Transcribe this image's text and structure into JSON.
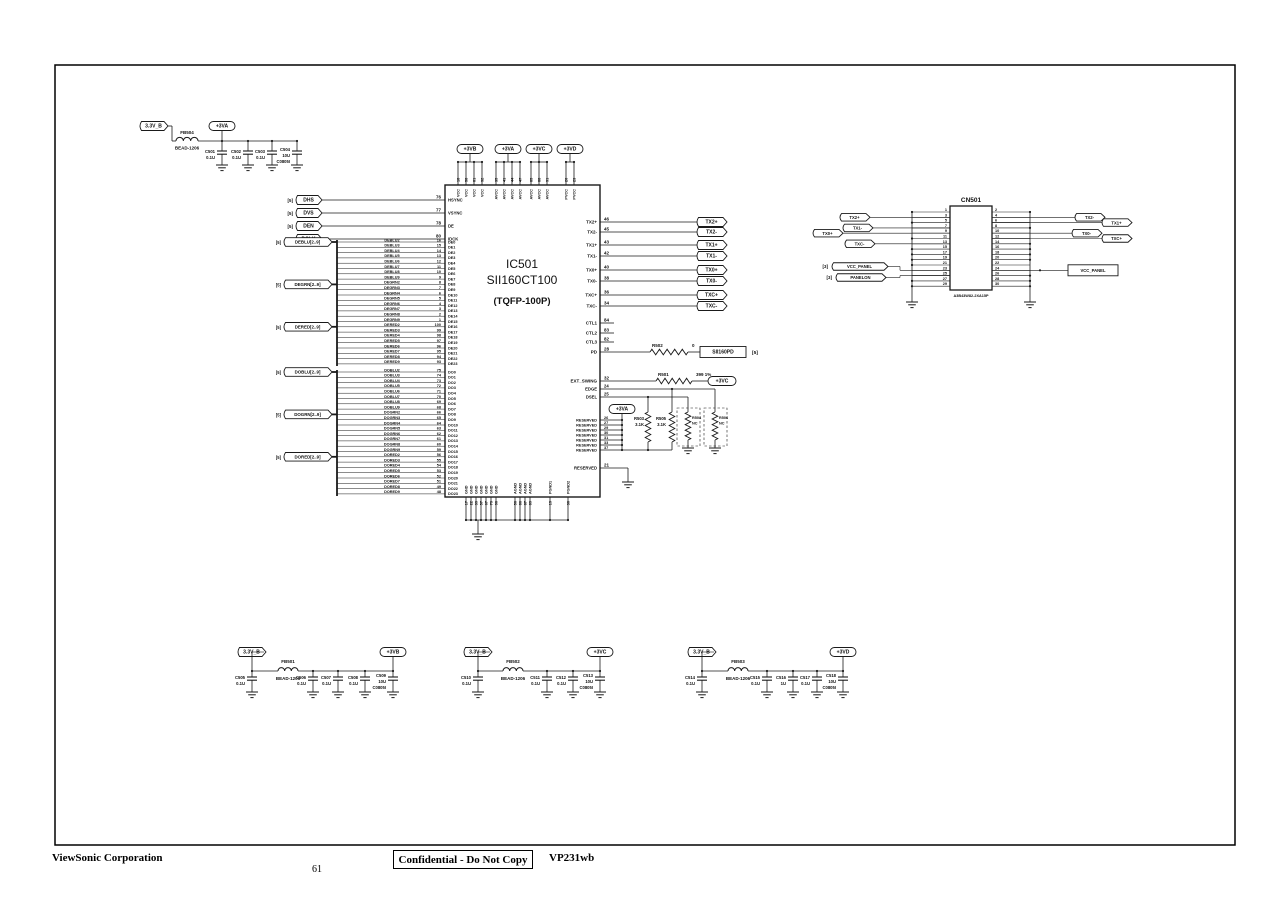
{
  "footer": {
    "company": "ViewSonic Corporation",
    "page_number": "61",
    "confidential": "Confidential - Do Not Copy",
    "model": "VP231wb"
  },
  "power_filters": [
    {
      "input": "3.3V_B",
      "bead": {
        "ref": "FB504",
        "part": "BEAD-1206"
      },
      "output": "+3VA",
      "caps": [
        [
          "C501",
          "0.1U"
        ],
        [
          "C502",
          "0.1U"
        ],
        [
          "C503",
          "0.1U"
        ],
        [
          "C504",
          "10U",
          "C0805I"
        ]
      ]
    },
    {
      "input": "3.3V_B",
      "bead": {
        "ref": "FB501",
        "part": "BEAD-1206"
      },
      "output": "+3VB",
      "pre_cap": [
        "C505",
        "0.1U"
      ],
      "caps": [
        [
          "C506",
          "0.1U"
        ],
        [
          "C507",
          "0.1U"
        ],
        [
          "C508",
          "0.1U"
        ],
        [
          "C509",
          "10U",
          "C0805I"
        ]
      ]
    },
    {
      "input": "3.3V_B",
      "bead": {
        "ref": "FB502",
        "part": "BEAD-1206"
      },
      "output": "+3VC",
      "pre_cap": [
        "C510",
        "0.1U"
      ],
      "caps": [
        [
          "C511",
          "0.1U"
        ],
        [
          "C512",
          "0.1U"
        ],
        [
          "C513",
          "10U",
          "C0805I"
        ]
      ]
    },
    {
      "input": "3.3V_B",
      "bead": {
        "ref": "FB503",
        "part": "BEAD-1206"
      },
      "output": "+3VD",
      "pre_cap": [
        "C514",
        "0.1U"
      ],
      "caps": [
        [
          "C515",
          "0.1U"
        ],
        [
          "C516",
          "1U"
        ],
        [
          "C517",
          "0.1U"
        ],
        [
          "C518",
          "10U",
          "C0805I"
        ]
      ]
    }
  ],
  "ic": {
    "ref": "IC501",
    "part": "SII160CT100",
    "package": "(TQFP-100P)",
    "control_inputs": [
      {
        "sheet": "[5]",
        "name": "DHS",
        "pin": "76",
        "signal": "HSYNC"
      },
      {
        "sheet": "[5]",
        "name": "DVS",
        "pin": "77",
        "signal": "VSYNC"
      },
      {
        "sheet": "[5]",
        "name": "DEN",
        "pin": "78",
        "signal": "DE"
      },
      {
        "sheet": "[5]",
        "name": "DCLK",
        "pin": "80",
        "signal": "IDCK"
      }
    ],
    "input_buses": [
      {
        "sheet": "[5]",
        "name": "DEBLU[2..9]"
      },
      {
        "sheet": "[5]",
        "name": "DEGRN[2..9]"
      },
      {
        "sheet": "[5]",
        "name": "DERED[2..9]"
      }
    ],
    "input_bits": [
      [
        "DEBLU2",
        "16",
        "DE0"
      ],
      [
        "DEBLU3",
        "15",
        "DE1"
      ],
      [
        "DEBLU4",
        "14",
        "DE2"
      ],
      [
        "DEBLU5",
        "13",
        "DE3"
      ],
      [
        "DEBLU6",
        "12",
        "DE4"
      ],
      [
        "DEBLU7",
        "11",
        "DE5"
      ],
      [
        "DEBLU8",
        "10",
        "DE6"
      ],
      [
        "DEBLU9",
        "9",
        "DE7"
      ],
      [
        "DEGRN2",
        "8",
        "DE8"
      ],
      [
        "DEGRN3",
        "7",
        "DE9"
      ],
      [
        "DEGRN4",
        "6",
        "DE10"
      ],
      [
        "DEGRN5",
        "5",
        "DE11"
      ],
      [
        "DEGRN6",
        "4",
        "DE12"
      ],
      [
        "DEGRN7",
        "3",
        "DE13"
      ],
      [
        "DEGRN8",
        "2",
        "DE14"
      ],
      [
        "DEGRN9",
        "1",
        "DE15"
      ],
      [
        "DERED2",
        "100",
        "DE16"
      ],
      [
        "DERED3",
        "99",
        "DE17"
      ],
      [
        "DERED4",
        "98",
        "DE18"
      ],
      [
        "DERED5",
        "97",
        "DE19"
      ],
      [
        "DERED6",
        "96",
        "DE20"
      ],
      [
        "DERED7",
        "95",
        "DE21"
      ],
      [
        "DERED8",
        "94",
        "DE22"
      ],
      [
        "DERED9",
        "93",
        "DE23"
      ]
    ],
    "output_buses": [
      {
        "sheet": "[5]",
        "name": "DOBLU[2..9]"
      },
      {
        "sheet": "[5]",
        "name": "DOGRN[2..9]"
      },
      {
        "sheet": "[5]",
        "name": "DORED[2..9]"
      }
    ],
    "output_bits": [
      [
        "DOBLU2",
        "75",
        "DO0"
      ],
      [
        "DOBLU3",
        "74",
        "DO1"
      ],
      [
        "DOBLU4",
        "73",
        "DO2"
      ],
      [
        "DOBLU5",
        "72",
        "DO3"
      ],
      [
        "DOBLU6",
        "71",
        "DO4"
      ],
      [
        "DOBLU7",
        "70",
        "DO5"
      ],
      [
        "DOBLU8",
        "69",
        "DO6"
      ],
      [
        "DOBLU9",
        "68",
        "DO7"
      ],
      [
        "DOGRN2",
        "66",
        "DO8"
      ],
      [
        "DOGRN3",
        "65",
        "DO9"
      ],
      [
        "DOGRN4",
        "64",
        "DO10"
      ],
      [
        "DOGRN5",
        "63",
        "DO11"
      ],
      [
        "DOGRN6",
        "62",
        "DO12"
      ],
      [
        "DOGRN7",
        "61",
        "DO13"
      ],
      [
        "DOGRN8",
        "60",
        "DO14"
      ],
      [
        "DOGRN9",
        "59",
        "DO15"
      ],
      [
        "DORED2",
        "56",
        "DO16"
      ],
      [
        "DORED3",
        "55",
        "DO17"
      ],
      [
        "DORED4",
        "54",
        "DO18"
      ],
      [
        "DORED5",
        "53",
        "DO19"
      ],
      [
        "DORED6",
        "52",
        "DO20"
      ],
      [
        "DORED7",
        "51",
        "DO21"
      ],
      [
        "DORED8",
        "49",
        "DO22"
      ],
      [
        "DORED9",
        "48",
        "DO23"
      ]
    ],
    "power_groups": [
      {
        "flag": "+3VB",
        "pin_name": "VCC",
        "pins": [
          "18",
          "58",
          "81",
          "92"
        ]
      },
      {
        "flag": "+3VA",
        "pin_name": "AVCC",
        "pins": [
          "35",
          "41",
          "44",
          "47"
        ]
      },
      {
        "flag": "+3VC",
        "pin_name": "AVCC",
        "pins": [
          "85",
          "88",
          "91"
        ]
      },
      {
        "flag": "+3VD",
        "pin_name": "PVCC",
        "pins": [
          "20",
          "23"
        ]
      }
    ],
    "tx_pins": [
      [
        "46",
        "TX2+"
      ],
      [
        "45",
        "TX2-"
      ],
      [
        "43",
        "TX1+"
      ],
      [
        "42",
        "TX1-"
      ],
      [
        "40",
        "TX0+"
      ],
      [
        "38",
        "TX0-"
      ],
      [
        "36",
        "TXC+"
      ],
      [
        "34",
        "TXC-"
      ]
    ],
    "ctl_pins": [
      [
        "84",
        "CTL1"
      ],
      [
        "83",
        "CTL2"
      ],
      [
        "82",
        "CTL3"
      ]
    ],
    "pd_net": {
      "pin": "28",
      "signal": "PD",
      "res": [
        "R502",
        "0"
      ],
      "flag": "SII160PD",
      "sheet": "[5]"
    },
    "swing_net": {
      "pin": "32",
      "signal": "EXT_SWING",
      "res": [
        "R501",
        "399 1%"
      ],
      "flag": "+3VC"
    },
    "sel_pins": [
      [
        "24",
        "EDGE"
      ],
      [
        "25",
        "DSEL"
      ]
    ],
    "reserved_bank": {
      "name": "RESERVED",
      "pins": [
        "26",
        "27",
        "29",
        "30",
        "31",
        "33",
        "37"
      ]
    },
    "reserved_single": {
      "pin": "21",
      "name": "RESERVED"
    },
    "pull_network": {
      "supply_flag": "+3VA",
      "r1": [
        "R503",
        "3.1K"
      ],
      "r2": [
        "R505",
        "3.1K"
      ],
      "r3": [
        "R504",
        "NC"
      ],
      "r4": [
        "R506",
        "NC"
      ]
    },
    "ground_pins": {
      "gnd_name": "GND",
      "gnd": [
        "17",
        "22",
        "39",
        "57",
        "67",
        "79",
        "90"
      ],
      "agnd_name": "AGND",
      "agnd": [
        "50",
        "86",
        "87",
        "89"
      ],
      "pgnd": [
        [
          "19",
          "PGND1"
        ],
        [
          "30",
          "PGND2"
        ]
      ]
    }
  },
  "connector": {
    "ref": "CN501",
    "part": "A3B43W82-2XA15P",
    "left_pins": [
      "1",
      "3",
      "5",
      "7",
      "9",
      "11",
      "13",
      "15",
      "17",
      "19",
      "21",
      "23",
      "25",
      "27",
      "29"
    ],
    "right_pins": [
      "2",
      "4",
      "6",
      "8",
      "10",
      "12",
      "14",
      "16",
      "18",
      "20",
      "22",
      "24",
      "26",
      "28",
      "30"
    ],
    "left_flags": [
      {
        "sheet": "",
        "name": "TX2+",
        "pin": 3
      },
      {
        "sheet": "",
        "name": "TX1-",
        "pin": 7
      },
      {
        "sheet": "",
        "name": "TX0+",
        "pin": 9
      },
      {
        "sheet": "",
        "name": "TXC-",
        "pin": 13
      },
      {
        "sheet": "[3]",
        "name": "VCC_PANEL",
        "pin": 23
      },
      {
        "sheet": "[3]",
        "name": "PANELON",
        "pin": 25
      }
    ],
    "right_flags": [
      {
        "name": "TX2-",
        "pin": 4
      },
      {
        "name": "TX1+",
        "pin": 6
      },
      {
        "name": "TX0-",
        "pin": 10
      },
      {
        "name": "TXC+",
        "pin": 12
      },
      {
        "name": "VCC_PANEL",
        "pin": 24
      }
    ]
  }
}
